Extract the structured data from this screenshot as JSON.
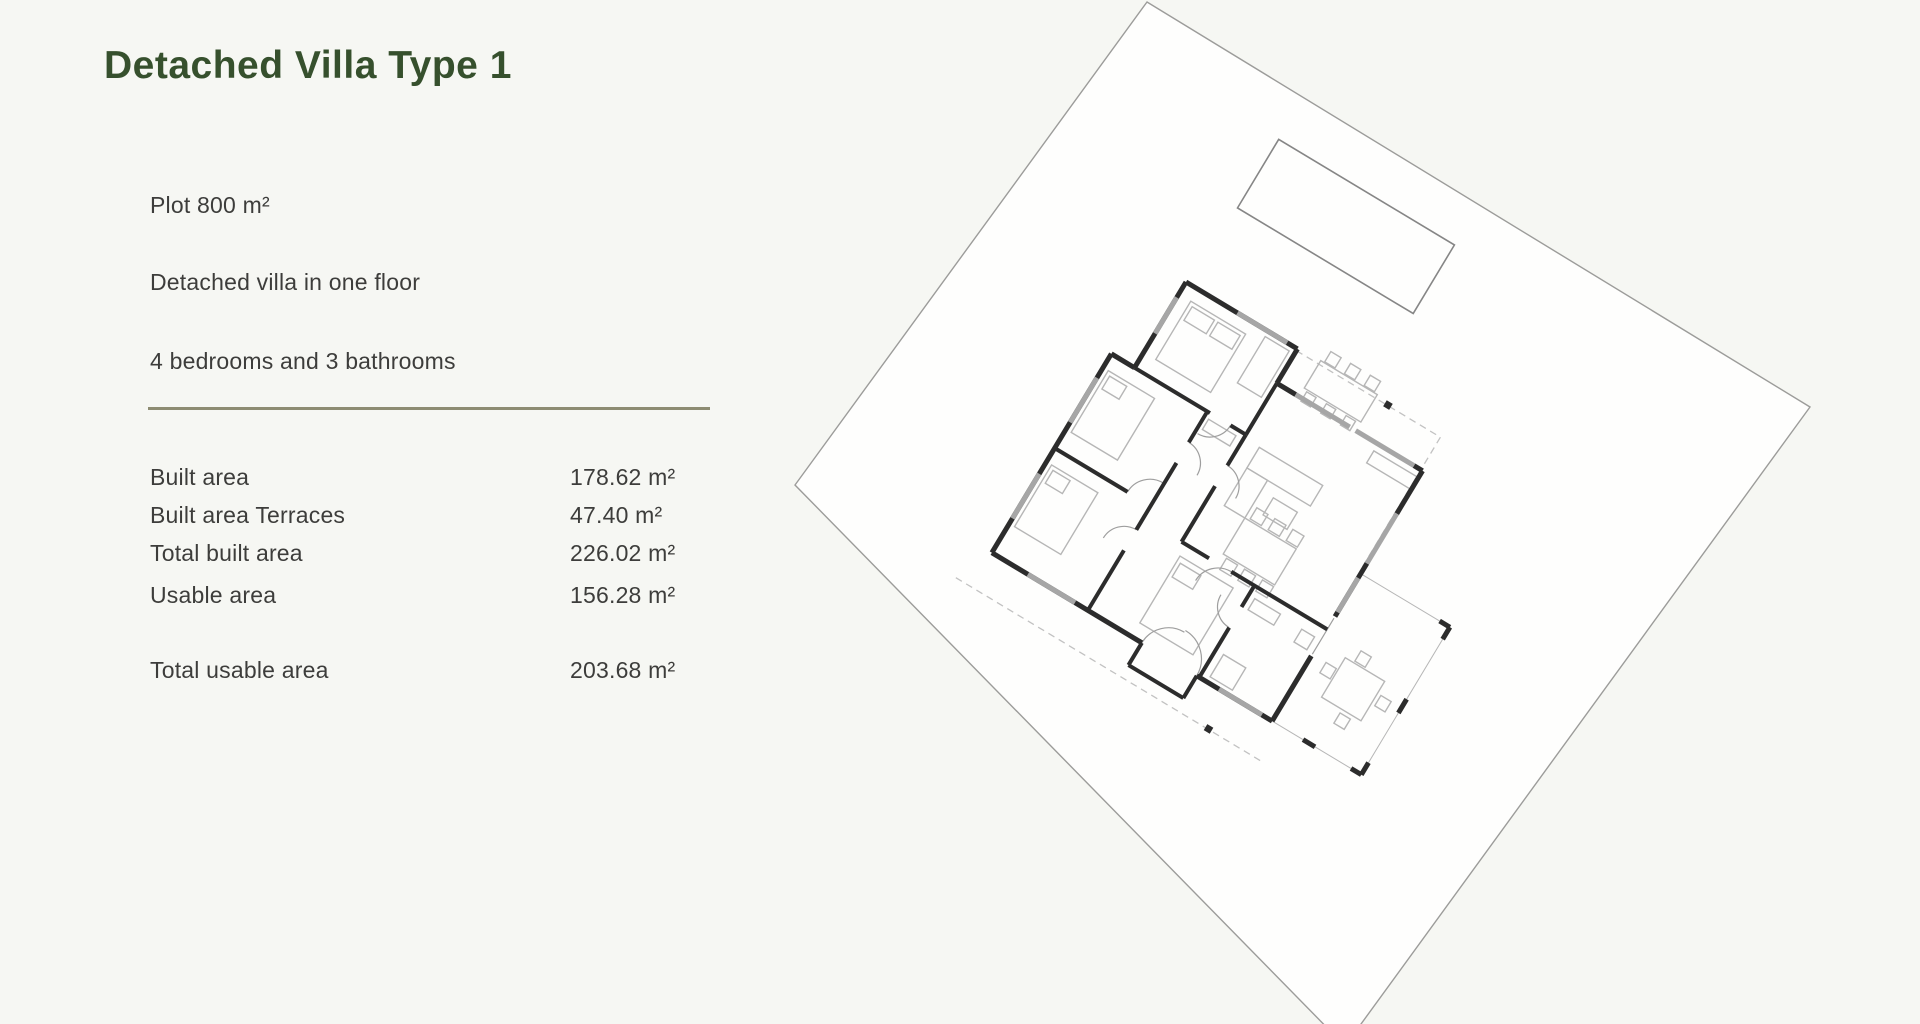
{
  "page": {
    "background": "#f6f7f3"
  },
  "header": {
    "title": "Detached Villa Type 1"
  },
  "specs": {
    "lines": [
      "Plot 800 m²",
      "Detached villa in one floor",
      "4 bedrooms and 3 bathrooms"
    ]
  },
  "areas": {
    "rows": [
      {
        "label": "Built area",
        "value": "178.62 m²"
      },
      {
        "label": "Built area Terraces",
        "value": "47.40 m²"
      },
      {
        "label": "Total built area",
        "value": "226.02 m²"
      },
      {
        "label": "Usable area",
        "value": "156.28 m²"
      }
    ],
    "total": {
      "label": "Total usable area",
      "value": "203.68 m²"
    }
  },
  "colors": {
    "title_green": "#36502d",
    "body_text": "#3d3d3b",
    "divider_olive": "#8d8c72"
  },
  "floorplan": {
    "label": "villa-type-1-site-plan",
    "rotation_deg": 31,
    "plot_fill": "#fefefd",
    "plot_line": "#9c9c9a",
    "pool_line": "#868686",
    "wall": "#2c2c2c",
    "window": "#a6a6a6",
    "furniture": "#b6b6b6",
    "dashed": "#c2c2c2",
    "door_arc": "#9e9e9e"
  }
}
